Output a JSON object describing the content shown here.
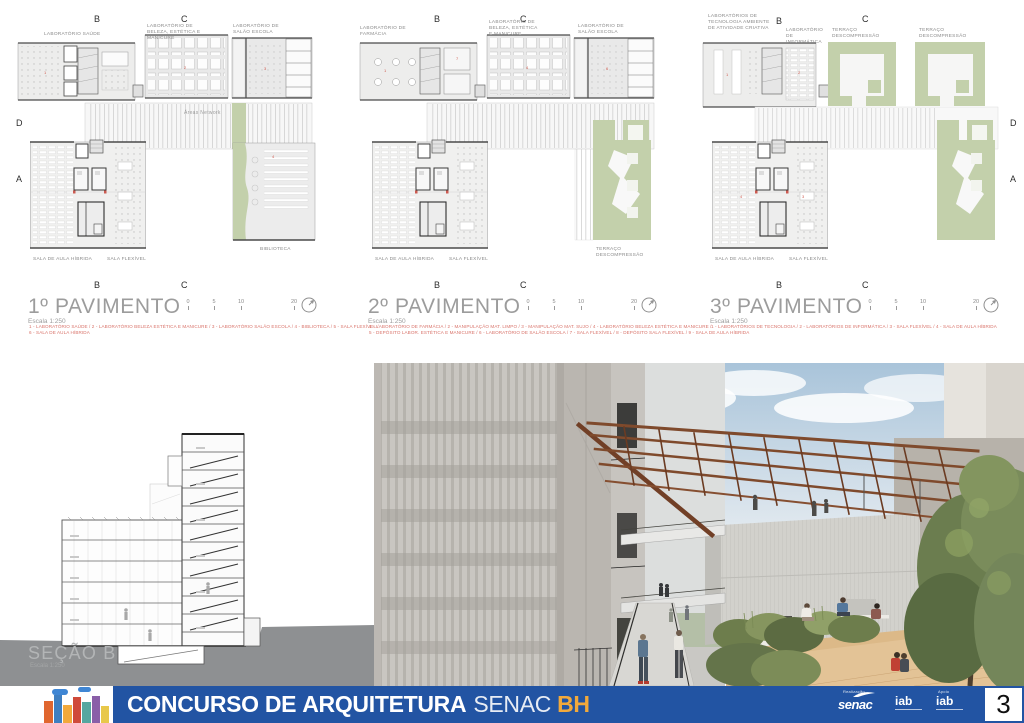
{
  "page": {
    "number": "3"
  },
  "banner": {
    "title_part1": "CONCURSO DE",
    "title_part2": "ARQUITETURA",
    "title_part3": "SENAC",
    "title_part4": "BH",
    "realizacao": "Realização",
    "apoio": "Apoio",
    "senac_logo": "senac",
    "iab_logo1": "iab",
    "iab_logo2": "iab",
    "colors": {
      "blue": "#2254a3",
      "orange": "#f2a93b"
    }
  },
  "plans": [
    {
      "title": "1º PAVIMENTO",
      "scale": "Escala 1:250",
      "scale_bar": [
        "0",
        "5",
        "10",
        "20"
      ],
      "legend_line1": "1 - LABORATÓRIO SAÚDE  /  2 - LABORATÓRIO BELEZA ESTÉTICA E MANICURE  /  3 - LABORATÓRIO SALÃO ESCOLA  /  4 - BIBLIOTECA  /  5 - SALA FLEXÍVEL  /",
      "legend_line2": "6 - SALA DE AULA HÍBRIDA",
      "labels": {
        "top_left": "LABORATÓRIO SAÚDE",
        "top_mid": "LABORATÓRIO DE BELEZA, ESTÉTICA E MANICURE",
        "top_right": "LABORATÓRIO DE SALÃO ESCOLA",
        "band": "Áreas Network",
        "bottom_left": "SALA DE AULA HÍBRIDA",
        "bottom_mid": "SALA FLEXÍVEL",
        "right": "BIBLIOTECA"
      },
      "grid": {
        "top_b": "B",
        "top_c": "C",
        "left_d": "D",
        "left_a": "A",
        "bottom_b": "B",
        "bottom_c": "C"
      },
      "room_numbers": [
        "1",
        "2",
        "3",
        "4"
      ]
    },
    {
      "title": "2º PAVIMENTO",
      "scale": "Escala 1:250",
      "scale_bar": [
        "0",
        "5",
        "10",
        "20"
      ],
      "legend_line1": "1 - LABORATÓRIO DE FARMÁCIA  /  2 - MANIPULAÇÃO MAT. LIMPO  /  3 - MANIPULAÇÃO MAT. SUJO  /  4 - LABORATÓRIO BELEZA ESTÉTICA E MANICURE  /",
      "legend_line2": "5 - DEPÓSITO LABOR. ESTÉTICA E MANICURE  /  6 - LABORATÓRIO DE SALÃO ESCOLA  /  7 - SALA FLEXÍVEL  /  8 - DEPÓSITO SALA FLEXÍVEL  /  9 - SALA DE AULA HÍBRIDA",
      "labels": {
        "top_left": "LABORATÓRIO DE FARMÁCIA",
        "top_mid": "LABORATÓRIO DE BELEZA, ESTÉTICA E MANICURE",
        "top_right": "LABORATÓRIO DE SALÃO ESCOLA",
        "bottom_left": "SALA DE AULA HÍBRIDA",
        "bottom_mid": "SALA FLEXÍVEL",
        "right": "TERRAÇO DESCOMPRESSÃO"
      },
      "grid": {
        "top_b": "B",
        "top_c": "C",
        "bottom_b": "B",
        "bottom_c": "C"
      },
      "room_numbers": [
        "1",
        "4",
        "6",
        "7"
      ]
    },
    {
      "title": "3º PAVIMENTO",
      "scale": "Escala 1:250",
      "scale_bar": [
        "0",
        "5",
        "10",
        "20"
      ],
      "legend_line1": "1 - LABORATÓRIOS DE TECNOLOGIA  /  2 - LABORATÓRIOS DE INFORMÁTICA  /  3 - SALA FLEXÍVEL  /  4 - SALA DE AULA HÍBRIDA",
      "legend_line2": "",
      "labels": {
        "top_left": "LABORATÓRIOS DE TECNOLOGIA AMBIENTE DE ATIVIDADE CRIATIVA",
        "top_mid": "LABORATÓRIO DE INFORMÁTICA",
        "terraco1": "TERRAÇO DESCOMPRESSÃO",
        "terraco2": "TERRAÇO DESCOMPRESSÃO",
        "bottom_left": "SALA DE AULA HÍBRIDA",
        "bottom_mid": "SALA FLEXÍVEL"
      },
      "grid": {
        "top_b": "B",
        "top_c": "C",
        "right_d": "D",
        "right_a": "A",
        "bottom_b": "B",
        "bottom_c": "C"
      },
      "room_numbers": [
        "1",
        "2",
        "3",
        "4"
      ]
    }
  ],
  "section": {
    "title": "SEÇÃO B",
    "scale": "Escala 1:250"
  },
  "palette": {
    "plan_gray": "#ededec",
    "terrace_green": "#c3d0ab",
    "legend_red": "#d9746b",
    "terrain_gray": "#8e9092",
    "pergola_brown": "#7f4a2c"
  }
}
